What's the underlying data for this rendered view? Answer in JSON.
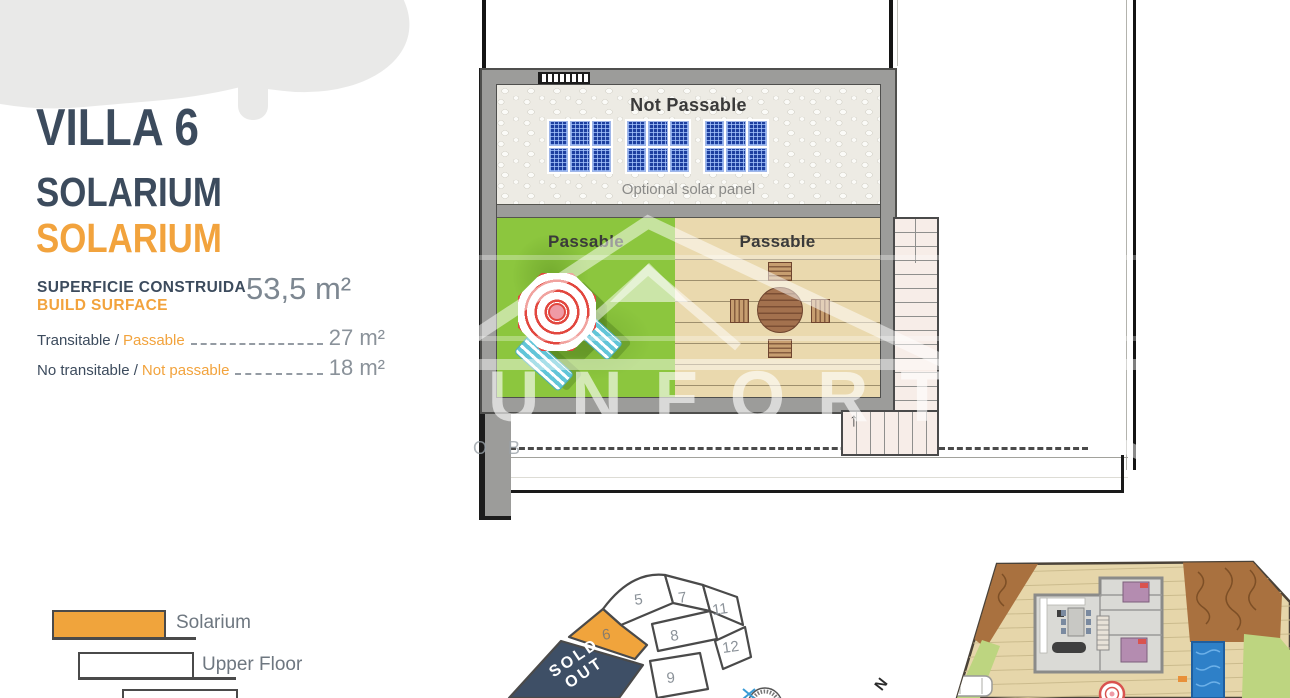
{
  "header": {
    "title": "VILLA 6",
    "subtitle": "SOLARIUM",
    "subtitle_alt": "SOLARIUM"
  },
  "surface": {
    "label_primary": "SUPERFICIE CONSTRUIDA",
    "label_secondary": "BUILD SURFACE",
    "total_value": "53,5 m²",
    "rows": [
      {
        "label": "Transitable /",
        "label_alt": "Passable",
        "value": "27 m²"
      },
      {
        "label": "No transitable /",
        "label_alt": "Not passable",
        "value": "18 m²"
      }
    ]
  },
  "floor_plan": {
    "zone_top_label": "Not Passable",
    "solar_caption": "Optional solar panel",
    "zone_left_label": "Passable",
    "zone_right_label": "Passable",
    "stairs_arrow": "↑"
  },
  "watermark": {
    "brand": "UNFORT",
    "tagline_fragment": "O B"
  },
  "legend": {
    "items": [
      {
        "label": "Solarium",
        "swatch_color": "#f0a43c"
      },
      {
        "label": "Upper Floor",
        "swatch_color": "#ffffff"
      },
      {
        "label": "",
        "swatch_color": "#ffffff"
      }
    ]
  },
  "plot_map": {
    "numbers": [
      "5",
      "7",
      "11",
      "6",
      "8",
      "12",
      "9"
    ],
    "highlighted_plot": "6",
    "sold_out_label": "SOLD OUT",
    "compass_letter": "N",
    "highlight_color": "#f0a43c",
    "sold_out_color": "#3e4f66"
  },
  "colors": {
    "accent_orange": "#f2a33d",
    "navy": "#3c4b5d",
    "value_gray": "#8a929a",
    "wall_gray": "#9c9c9a",
    "grass_green": "#8cc63e",
    "deck_tan": "#ead9ae",
    "solar_blue": "#1d3f9f",
    "pool_blue": "#2e80c8"
  }
}
